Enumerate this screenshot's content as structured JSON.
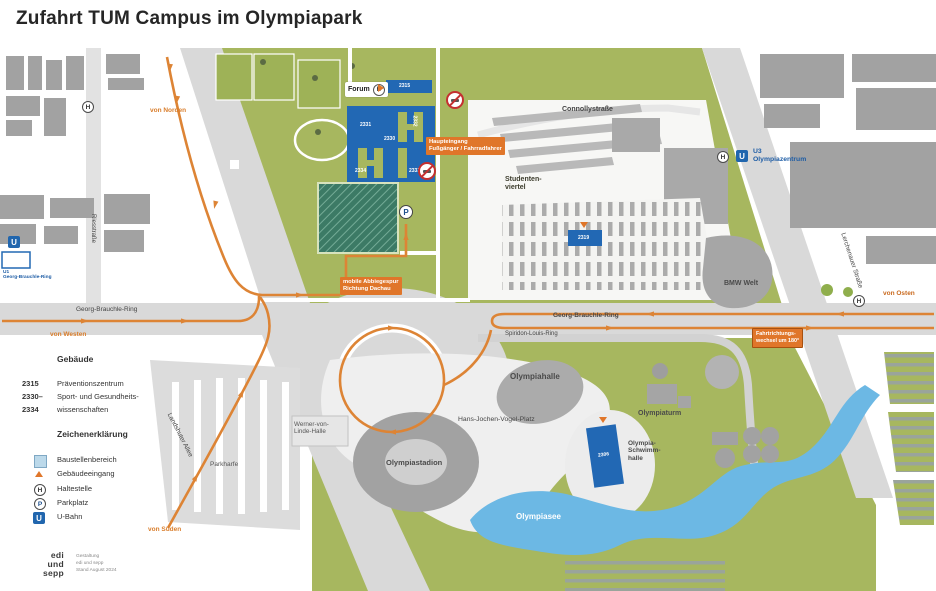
{
  "title": "Zufahrt TUM Campus im Olympiapark",
  "colors": {
    "route_orange": "#dd8435",
    "label_orange": "#e0762a",
    "park_green": "#a7b75f",
    "tum_blue": "#2268b4",
    "water_blue": "#6cb8e4",
    "building_gray": "#a2a2a2",
    "road_gray": "#d9d9d9"
  },
  "streets": {
    "georg_brauchle_ring_west": "Georg-Brauchle-Ring",
    "georg_brauchle_ring_east": "Georg-Brauchle-Ring",
    "spiridon_louis_ring": "Spiridon-Louis-Ring",
    "connollystrasse": "Connollystraße",
    "lerchenauer_strasse": "Lerchenauer Straße",
    "landshuter_allee": "Landshuter Allee",
    "riesstrasse": "Riesstraße"
  },
  "places": {
    "forum": "Forum",
    "studentenviertel_l1": "Studenten-",
    "studentenviertel_l2": "viertel",
    "olympiahalle": "Olympiahalle",
    "hans_jochen_vogel_platz": "Hans-Jochen-Vogel-Platz",
    "olympiaturm": "Olympiaturm",
    "schwimmhalle_l1": "Olympia-",
    "schwimmhalle_l2": "Schwimm-",
    "schwimmhalle_l3": "halle",
    "olympiastadion": "Olympiastadion",
    "werner_von_linde_l1": "Werner-von-",
    "werner_von_linde_l2": "Linde-Halle",
    "olympiasee": "Olympiasee",
    "bmw_welt": "BMW Welt",
    "parkharfe": "Parkharfe",
    "u3_line": "U3",
    "u3_station": "Olympiazentrum",
    "u1_line": "U1",
    "u1_station": "Georg-Brauchle-Ring"
  },
  "buildings": {
    "bar_2315": "2315",
    "b2331": "2331",
    "b2332": "2332",
    "b2330": "2330",
    "b2334": "2334",
    "b2333": "2333",
    "b2319": "2319",
    "b2306": "2306"
  },
  "route_labels": {
    "von_norden": "von Norden",
    "von_westen": "von Westen",
    "von_osten": "von Osten",
    "von_sueden": "von Süden",
    "haupteingang_l1": "Haupteingang",
    "haupteingang_l2": "Fußgänger / Fahrradfahrer",
    "abbiegespur_l1": "mobile Abbiegespur",
    "abbiegespur_l2": "Richtung Dachau",
    "wechsel_l1": "Fahrtrichtungs-",
    "wechsel_l2": "wechsel um 180°"
  },
  "icons": {
    "h": "H",
    "p": "P",
    "u": "U"
  },
  "legend": {
    "buildings_heading": "Gebäude",
    "building_rows": [
      {
        "num": "2315",
        "name": "Präventionszentrum"
      },
      {
        "num": "2330–",
        "name": "Sport- und Gesundheits-"
      },
      {
        "num": "2334",
        "name": "wissenschaften"
      }
    ],
    "symbols_heading": "Zeichenerklärung",
    "symbol_rows": [
      {
        "icon": "construction-area-swatch",
        "label": "Baustellenbereich"
      },
      {
        "icon": "building-entrance-triangle",
        "label": "Gebäudeeingang"
      },
      {
        "icon": "stop-circle-h",
        "label": "Haltestelle"
      },
      {
        "icon": "parking-circle-p",
        "label": "Parkplatz"
      },
      {
        "icon": "ubahn-square-u",
        "label": "U-Bahn"
      }
    ]
  },
  "credits": {
    "logo_l1": "edi",
    "logo_l2": "und",
    "logo_l3": "sepp",
    "line1": "Gestaltung",
    "line2": "edi und sepp",
    "line3": "Stand August 2024"
  }
}
